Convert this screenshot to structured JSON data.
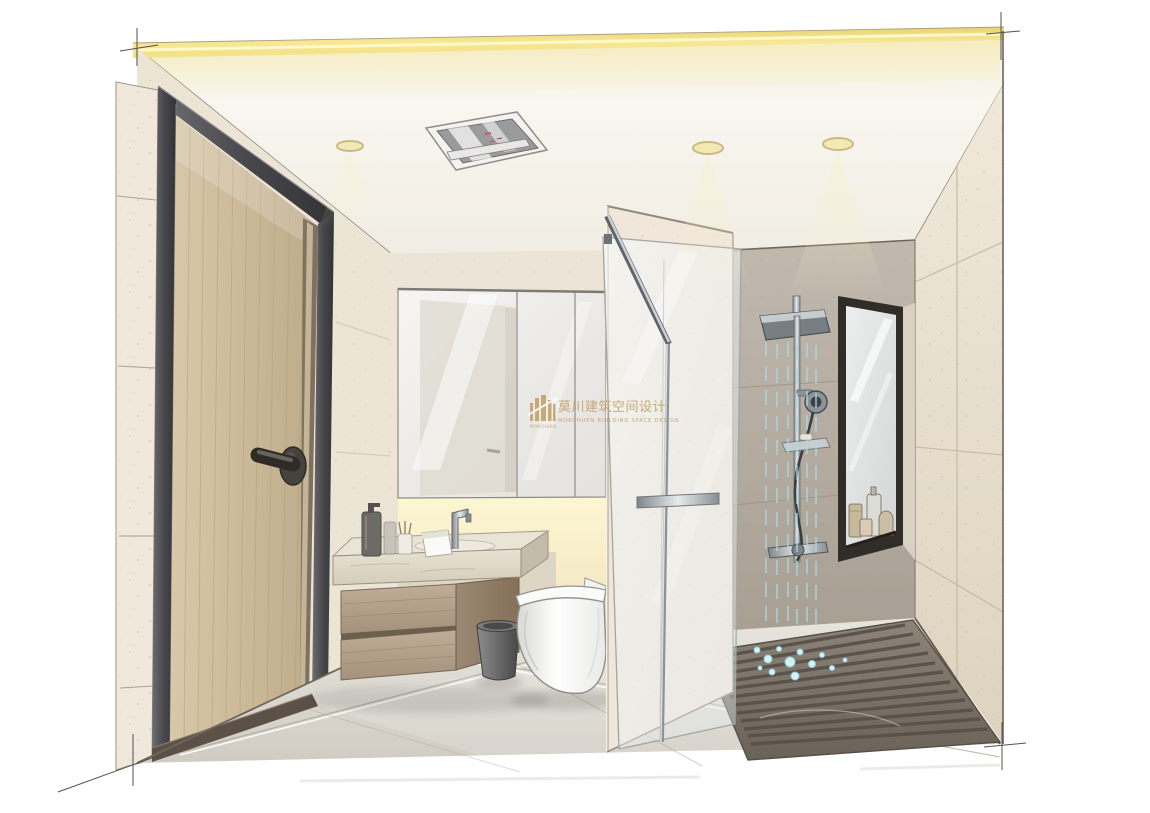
{
  "meta": {
    "kind": "hand-drawn interior perspective rendering",
    "room": "bathroom",
    "style": "marker-sketch architectural visualization"
  },
  "watermark": {
    "cn": "莫川建筑空间设计",
    "en": "MOKCHUEN BUILDING SPACE DESIGN",
    "logo_text": "MOKCHUEN",
    "color": "#c3a470"
  },
  "palette": {
    "background": "#ffffff",
    "cove_light": "#f2df7e",
    "ceiling": "#f8f5ee",
    "wall_beige": "#ece5d6",
    "wall_gray": "#b7afa4",
    "door_wood": "#ccbb9c",
    "door_frame": "#46464a",
    "glass": "#eef3f3",
    "chrome": "#9aa2a8",
    "floor_light": "#dcd8cf",
    "shower_floor_dark": "#7d7468",
    "water": "#aadbe4",
    "toilet_white": "#f6f6f5",
    "watermark_gold": "#c3a470"
  },
  "scene": {
    "objects": [
      "entry door with dark frame and lever handle",
      "cove light strip at ceiling edge",
      "three recessed downlights",
      "ceiling ventilation unit",
      "mirror cabinet over vanity",
      "floating wood vanity with stone counter, soap bottles, tissue box and faucet",
      "one-piece toilet",
      "trash bin",
      "open glass shower door on tiled partition",
      "rain shower column with hand shower and valve",
      "tall black-framed niche window with toiletry bottles",
      "dark stone shower floor with slats and water splashes",
      "large-format tiled walls and gray tiled floor"
    ]
  }
}
